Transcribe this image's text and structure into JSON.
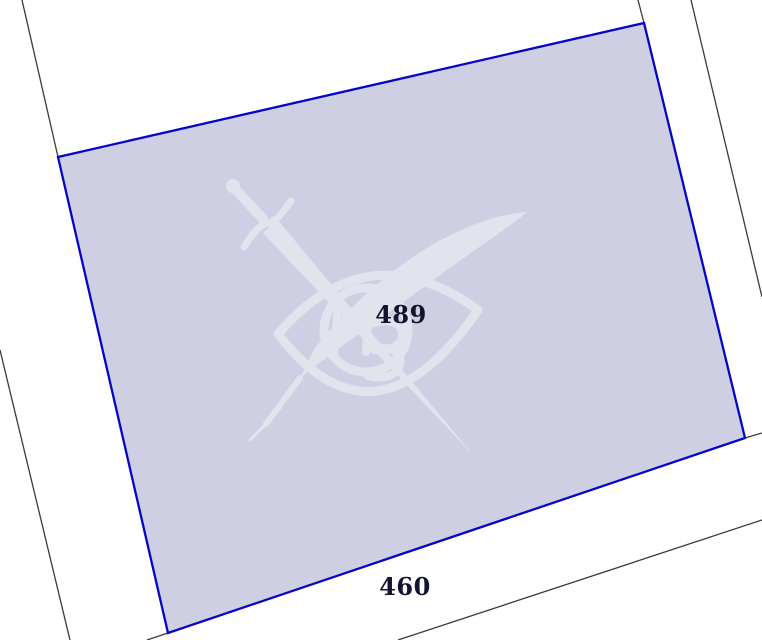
{
  "view": {
    "type": "cadastral-map",
    "background_color": "#ffffff",
    "width": 762,
    "height": 640
  },
  "parcel": {
    "points": "58,157 644,23 745,438 168,633",
    "fill_color": "#cfcfe3",
    "border_color": "#0505c8",
    "border_width": 2.3,
    "label": {
      "text": "489",
      "x": 401,
      "y": 323,
      "font_size": 24
    }
  },
  "neighbor_label": {
    "text": "460",
    "x": 405,
    "y": 595,
    "font_size": 24
  },
  "labels": {
    "color": "#13132e"
  },
  "boundary_lines": {
    "color": "#3a3a3a",
    "width": 1.3,
    "segments": [
      {
        "x1": 22,
        "y1": 0,
        "x2": 58,
        "y2": 157
      },
      {
        "x1": 638,
        "y1": 0,
        "x2": 644,
        "y2": 23
      },
      {
        "x1": 745,
        "y1": 438,
        "x2": 762,
        "y2": 433
      },
      {
        "x1": 168,
        "y1": 633,
        "x2": 147,
        "y2": 640
      },
      {
        "x1": 0,
        "y1": 350,
        "x2": 70,
        "y2": 640
      },
      {
        "x1": 691,
        "y1": 0,
        "x2": 762,
        "y2": 297
      },
      {
        "x1": 398,
        "y1": 640,
        "x2": 762,
        "y2": 520
      }
    ]
  },
  "watermark": {
    "name": "sword-quill-eye-emblem",
    "color": "#ffffff",
    "opacity": 0.42
  }
}
